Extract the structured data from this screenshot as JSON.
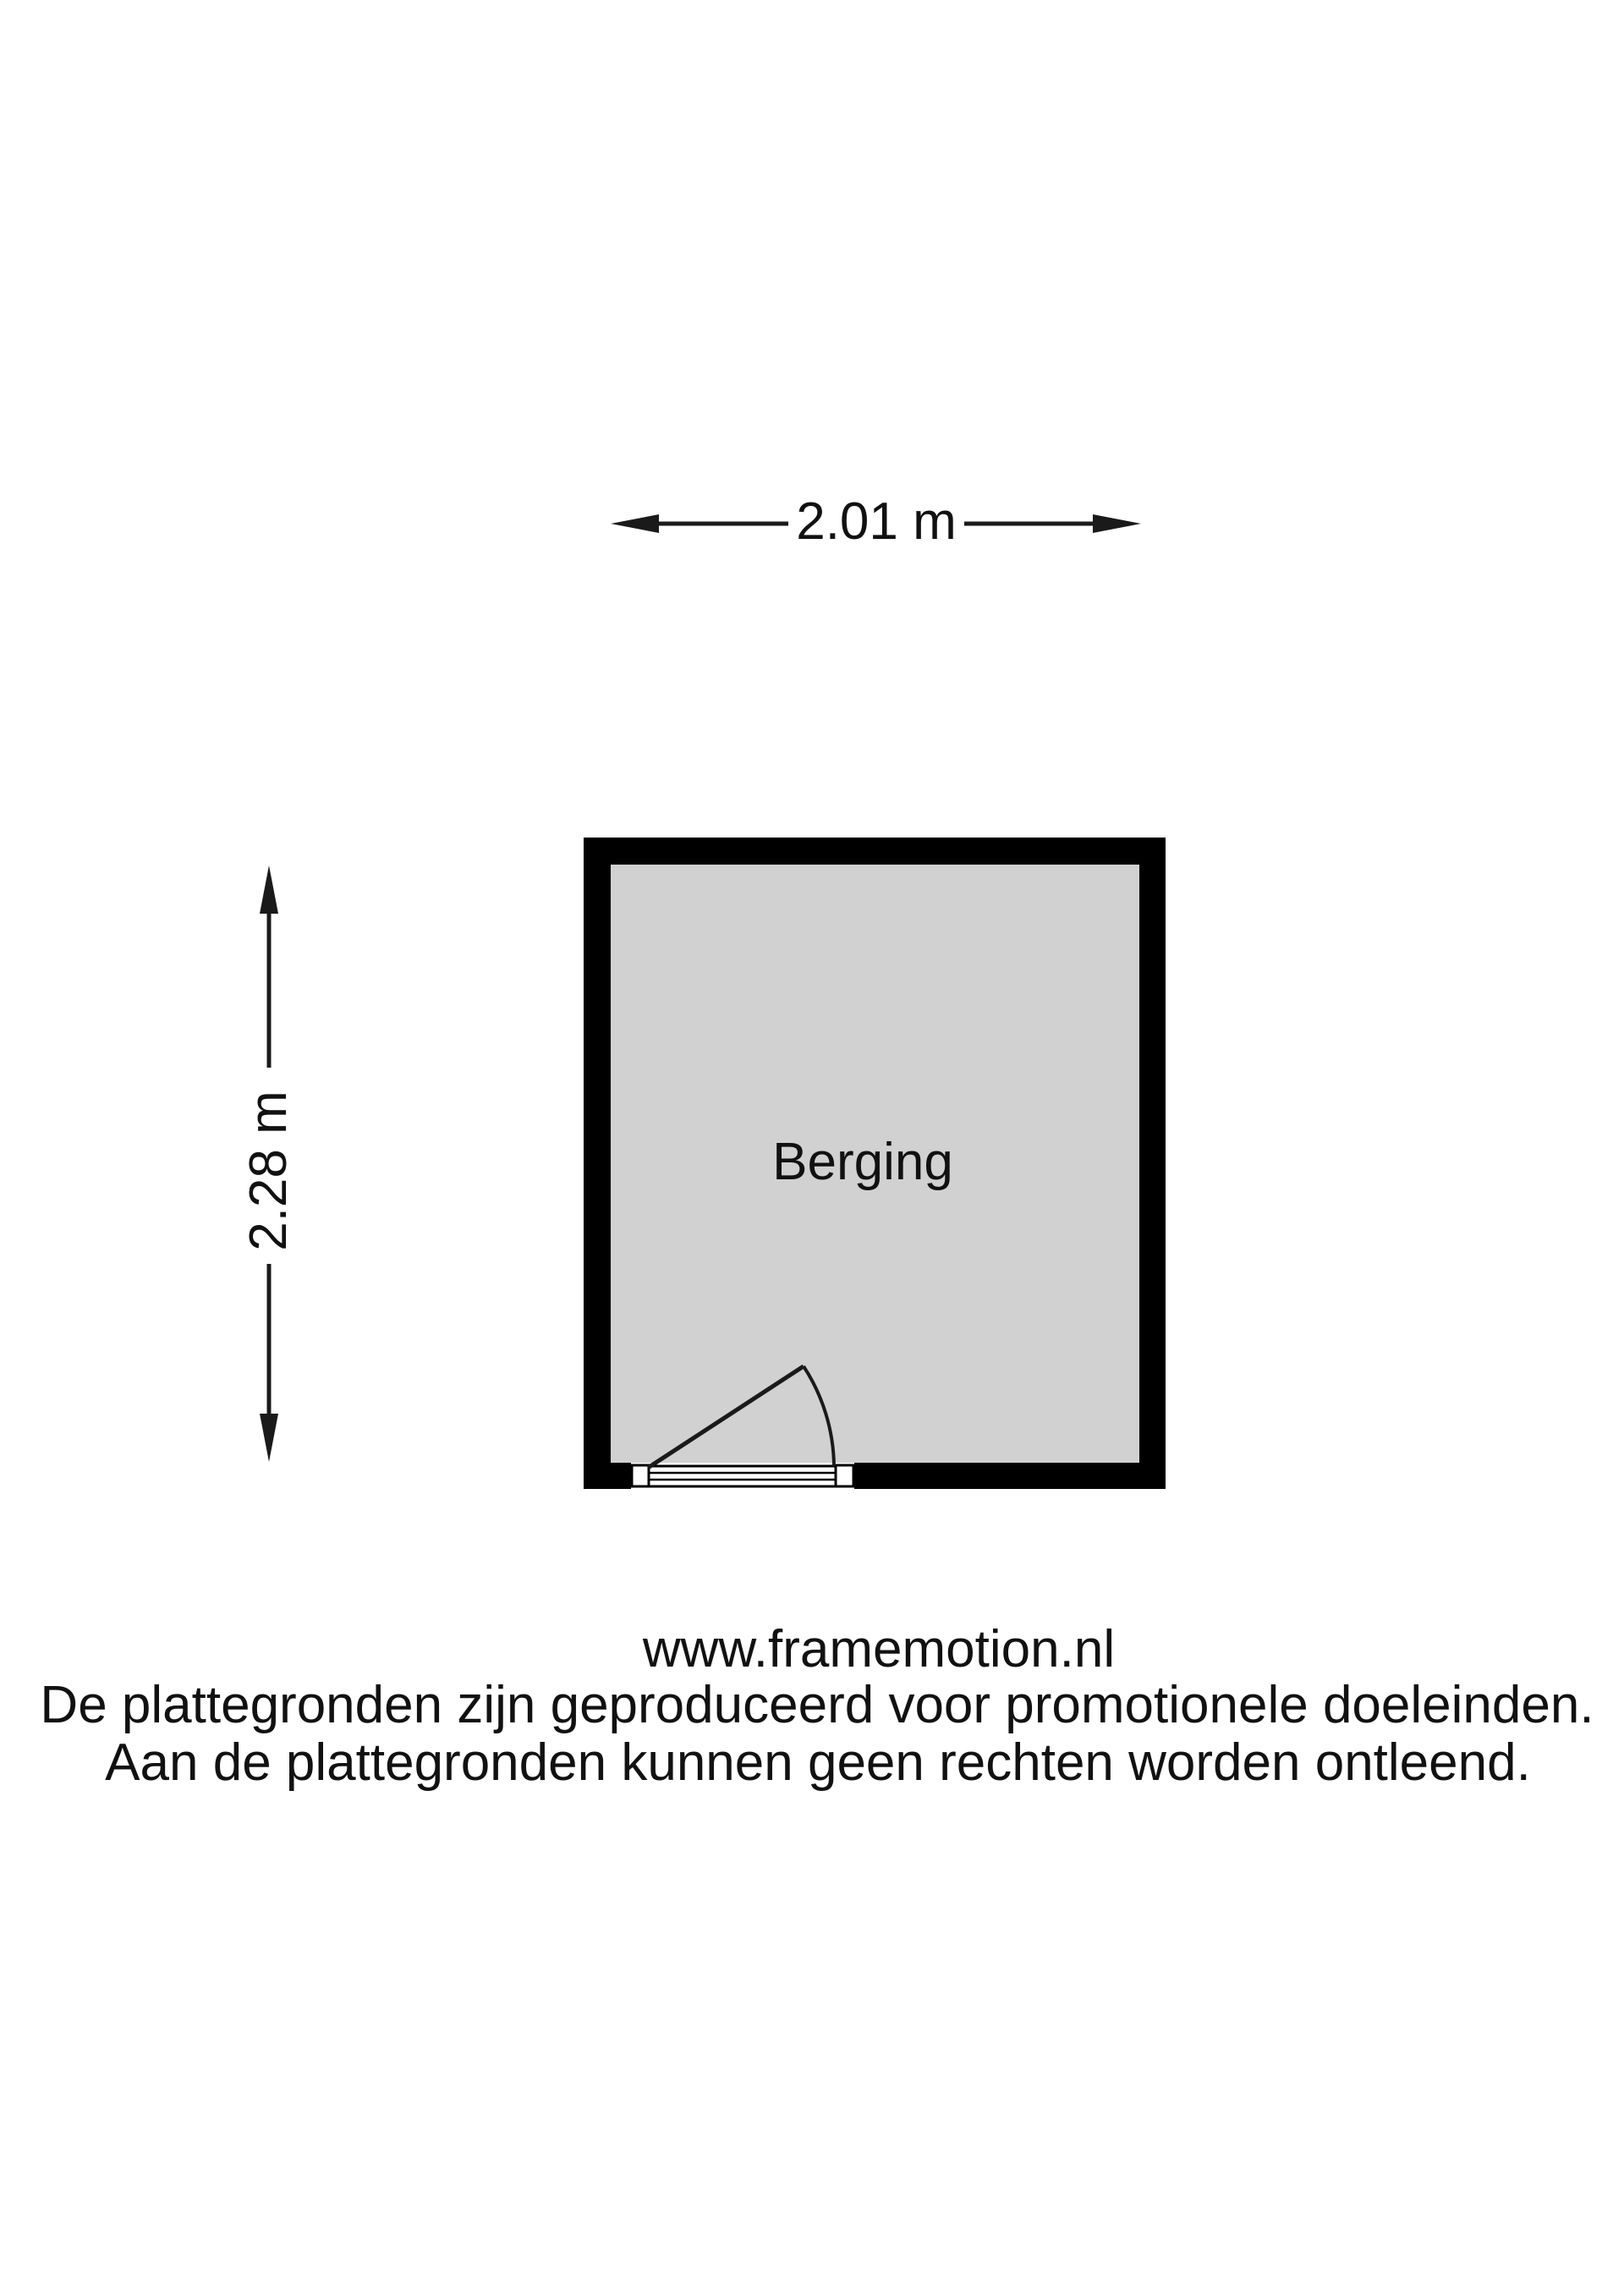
{
  "floorplan": {
    "room_label": "Berging",
    "width_dimension_label": "2.01 m",
    "height_dimension_label": "2.28 m"
  },
  "footer": {
    "website": "www.framemotion.nl",
    "disclaimer_line1": "De plattegronden zijn geproduceerd voor promotionele doeleinden.",
    "disclaimer_line2": "Aan de plattegronden kunnen geen rechten worden ontleend."
  },
  "colors": {
    "wall": "#000000",
    "floor_fill": "#d1d1d1",
    "background": "#ffffff",
    "line": "#1a1a1a",
    "text": "#111111"
  }
}
